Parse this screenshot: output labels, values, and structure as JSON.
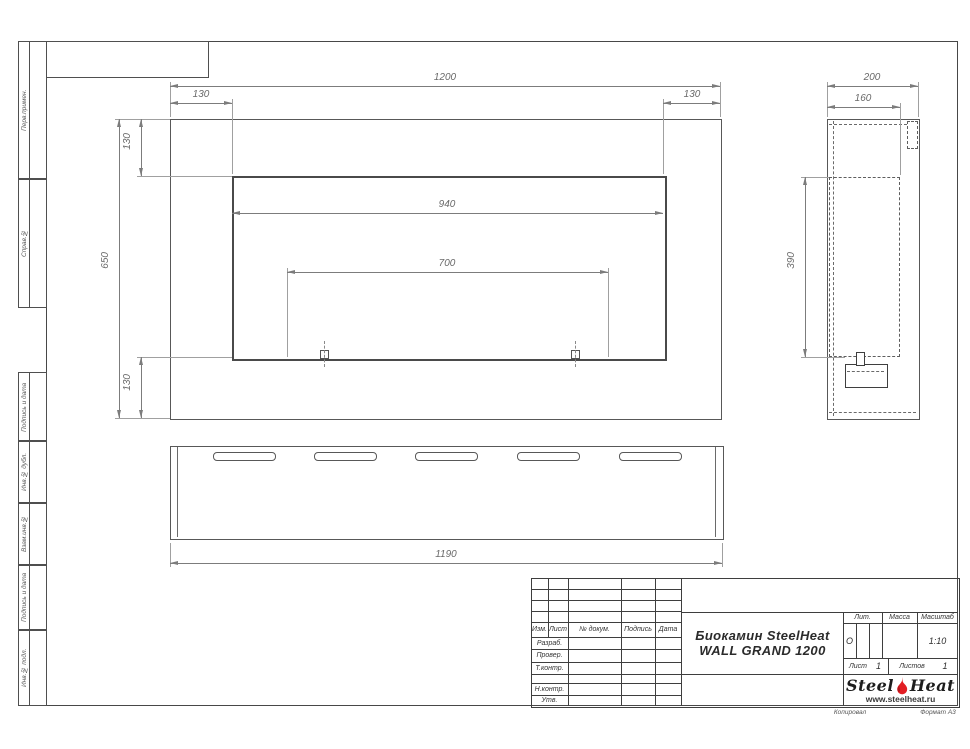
{
  "sheet": {
    "copy_label": "Копировал",
    "format_label": "Формат А3"
  },
  "margin_labels": [
    "Перв.примен.",
    "Справ.№",
    "Подпись и дата",
    "Инв.№ дубл.",
    "Взам.инв.№",
    "Подпись и дата",
    "Инв.№ подл."
  ],
  "dims": {
    "front_width": "1200",
    "front_left_inset": "130",
    "front_right_inset": "130",
    "front_height": "650",
    "front_top_inset": "130",
    "front_bottom_inset": "130",
    "opening_width": "940",
    "burner_span": "700",
    "base_length": "1190",
    "side_depth": "200",
    "side_inner_depth": "160",
    "side_opening_height": "390"
  },
  "title_block": {
    "col_izm": "Изм.",
    "col_list": "Лист",
    "col_doc": "№ докум.",
    "col_sign": "Подпись",
    "col_date": "Дата",
    "row_developed": "Разраб.",
    "row_checked": "Провер.",
    "row_tcontrol": "Т.контр.",
    "row_ncontrol": "Н.контр.",
    "row_approved": "Утв.",
    "title_line1": "Биокамин SteelHeat",
    "title_line2": "WALL GRAND 1200",
    "lit_label": "Лит.",
    "lit_value": "О",
    "mass_label": "Масса",
    "scale_label": "Масштаб",
    "scale_value": "1:10",
    "sheet_label": "Лист",
    "sheet_value": "1",
    "sheets_label": "Листов",
    "sheets_value": "1",
    "brand_steel": "Steel",
    "brand_heat": "Heat",
    "brand_site": "www.steelheat.ru"
  },
  "colors": {
    "line": "#4f4f4f",
    "dimension": "#7c7c7c",
    "flame_red": "#e21e24",
    "background": "#ffffff"
  }
}
